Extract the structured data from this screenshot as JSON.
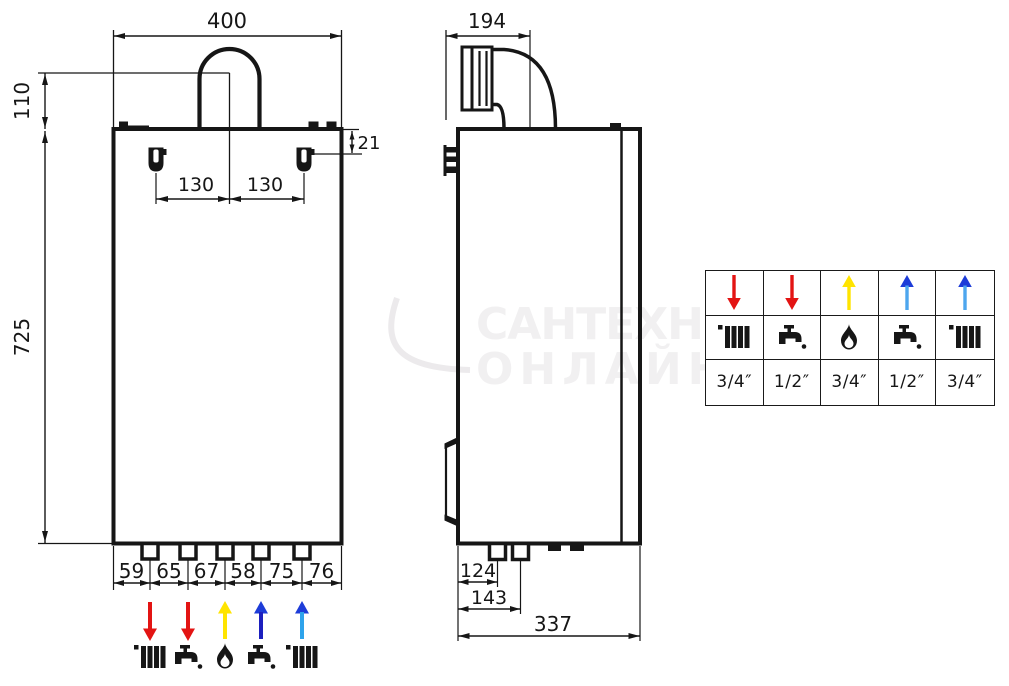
{
  "watermark": {
    "line1": "САНТЕХНИКА",
    "line2": "ОНЛАЙН"
  },
  "drawing": {
    "front_view": {
      "width_label": "400",
      "flue_height_label": "110",
      "height_label": "725",
      "hook_drop_label": "21",
      "hook_left_label": "130",
      "hook_right_label": "130",
      "bottom_spacings": [
        "59",
        "65",
        "67",
        "58",
        "75",
        "76"
      ]
    },
    "side_view": {
      "flue_offset_label": "194",
      "conn1_offset_label": "124",
      "conn2_offset_label": "143",
      "depth_label": "337"
    }
  },
  "legend_ports": [
    {
      "name": "heating-flow",
      "icon": "radiator-icon",
      "arrow": "down",
      "shaft": "#e31413",
      "head": "#e31413"
    },
    {
      "name": "dhw-outlet",
      "icon": "tap-icon",
      "arrow": "down",
      "shaft": "#e31413",
      "head": "#e31413"
    },
    {
      "name": "gas-inlet",
      "icon": "flame-icon",
      "arrow": "up",
      "shaft": "#ffe400",
      "head": "#ffe400"
    },
    {
      "name": "cold-water-inlet",
      "icon": "tap-icon",
      "arrow": "up",
      "shaft": "#1c1fbe",
      "head": "#1d3cd8"
    },
    {
      "name": "heating-return",
      "icon": "radiator-icon",
      "arrow": "up",
      "shaft": "#2ea3eb",
      "head": "#1d3cd8"
    }
  ],
  "connection_table": {
    "columns": [
      {
        "icon": "radiator-icon",
        "arrow": "down",
        "shaft": "#e31413",
        "head": "#e31413",
        "size": "3/4″"
      },
      {
        "icon": "tap-icon",
        "arrow": "down",
        "shaft": "#e31413",
        "head": "#e31413",
        "size": "1/2″"
      },
      {
        "icon": "flame-icon",
        "arrow": "up",
        "shaft": "#ffe400",
        "head": "#ffe400",
        "size": "3/4″"
      },
      {
        "icon": "tap-icon",
        "arrow": "up",
        "shaft": "#4da6ee",
        "head": "#1d3cd8",
        "size": "1/2″"
      },
      {
        "icon": "radiator-icon",
        "arrow": "up",
        "shaft": "#4da6ee",
        "head": "#1d3cd8",
        "size": "3/4″"
      }
    ]
  },
  "colors": {
    "line": "#161616",
    "watermark": "#f1f0f1",
    "background": "#ffffff"
  }
}
